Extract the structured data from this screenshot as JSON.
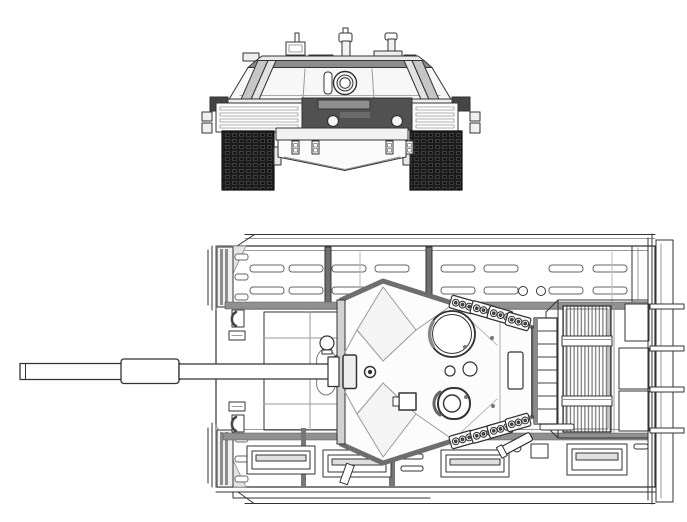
{
  "page": {
    "background_color": "#ffffff",
    "width_px": 687,
    "height_px": 522
  },
  "drawing": {
    "kind": "technical-line-drawing",
    "subject": "main-battle-tank-blueprint",
    "views": [
      {
        "name": "front-view",
        "parts": [
          "turret",
          "gun-mantlet",
          "sight-box",
          "antenna-masts",
          "turret-side-armor",
          "fender-stowage",
          "side-skirts",
          "headlights",
          "tracks",
          "glacis-plate",
          "tow-hooks"
        ]
      },
      {
        "name": "top-view",
        "parts": [
          "gun-barrel",
          "thermal-sleeve",
          "gun-mantlet",
          "turret",
          "commander-hatch",
          "loader-hatch",
          "gunner-sight",
          "smoke-grenade-launchers",
          "turret-bustle-rack",
          "engine-deck-grille",
          "hull",
          "side-skirts",
          "skirt-slots",
          "stowage-panels",
          "front-fenders",
          "rear-stowage-bins",
          "rear-antenna-rods",
          "driver-compartment",
          "ventilator-dome"
        ]
      }
    ]
  },
  "colors": {
    "background": "#ffffff",
    "line_dark": "#333333",
    "line_soft": "#999999",
    "fill_white": "#ffffff",
    "fill_light": "#f4f4f4",
    "panel_gray": "#d2d2d2",
    "side_armor_gray": "#c6c6c6",
    "side_armor_light": "#e2e2e2",
    "roof_band_gray": "#8c8c8c",
    "edge_band_gray": "#6e6e6e",
    "launcher_edge_gray": "#7a7a7a",
    "stowage_dark": "#4d4d4d",
    "hull_dark_panel": "#515151",
    "fender_cap_dark": "#454545",
    "track_black": "#1c1c1c",
    "shade_band": "#909090",
    "divider_gray": "#6f6f6f",
    "corner_shade": "#e4e4e4"
  }
}
